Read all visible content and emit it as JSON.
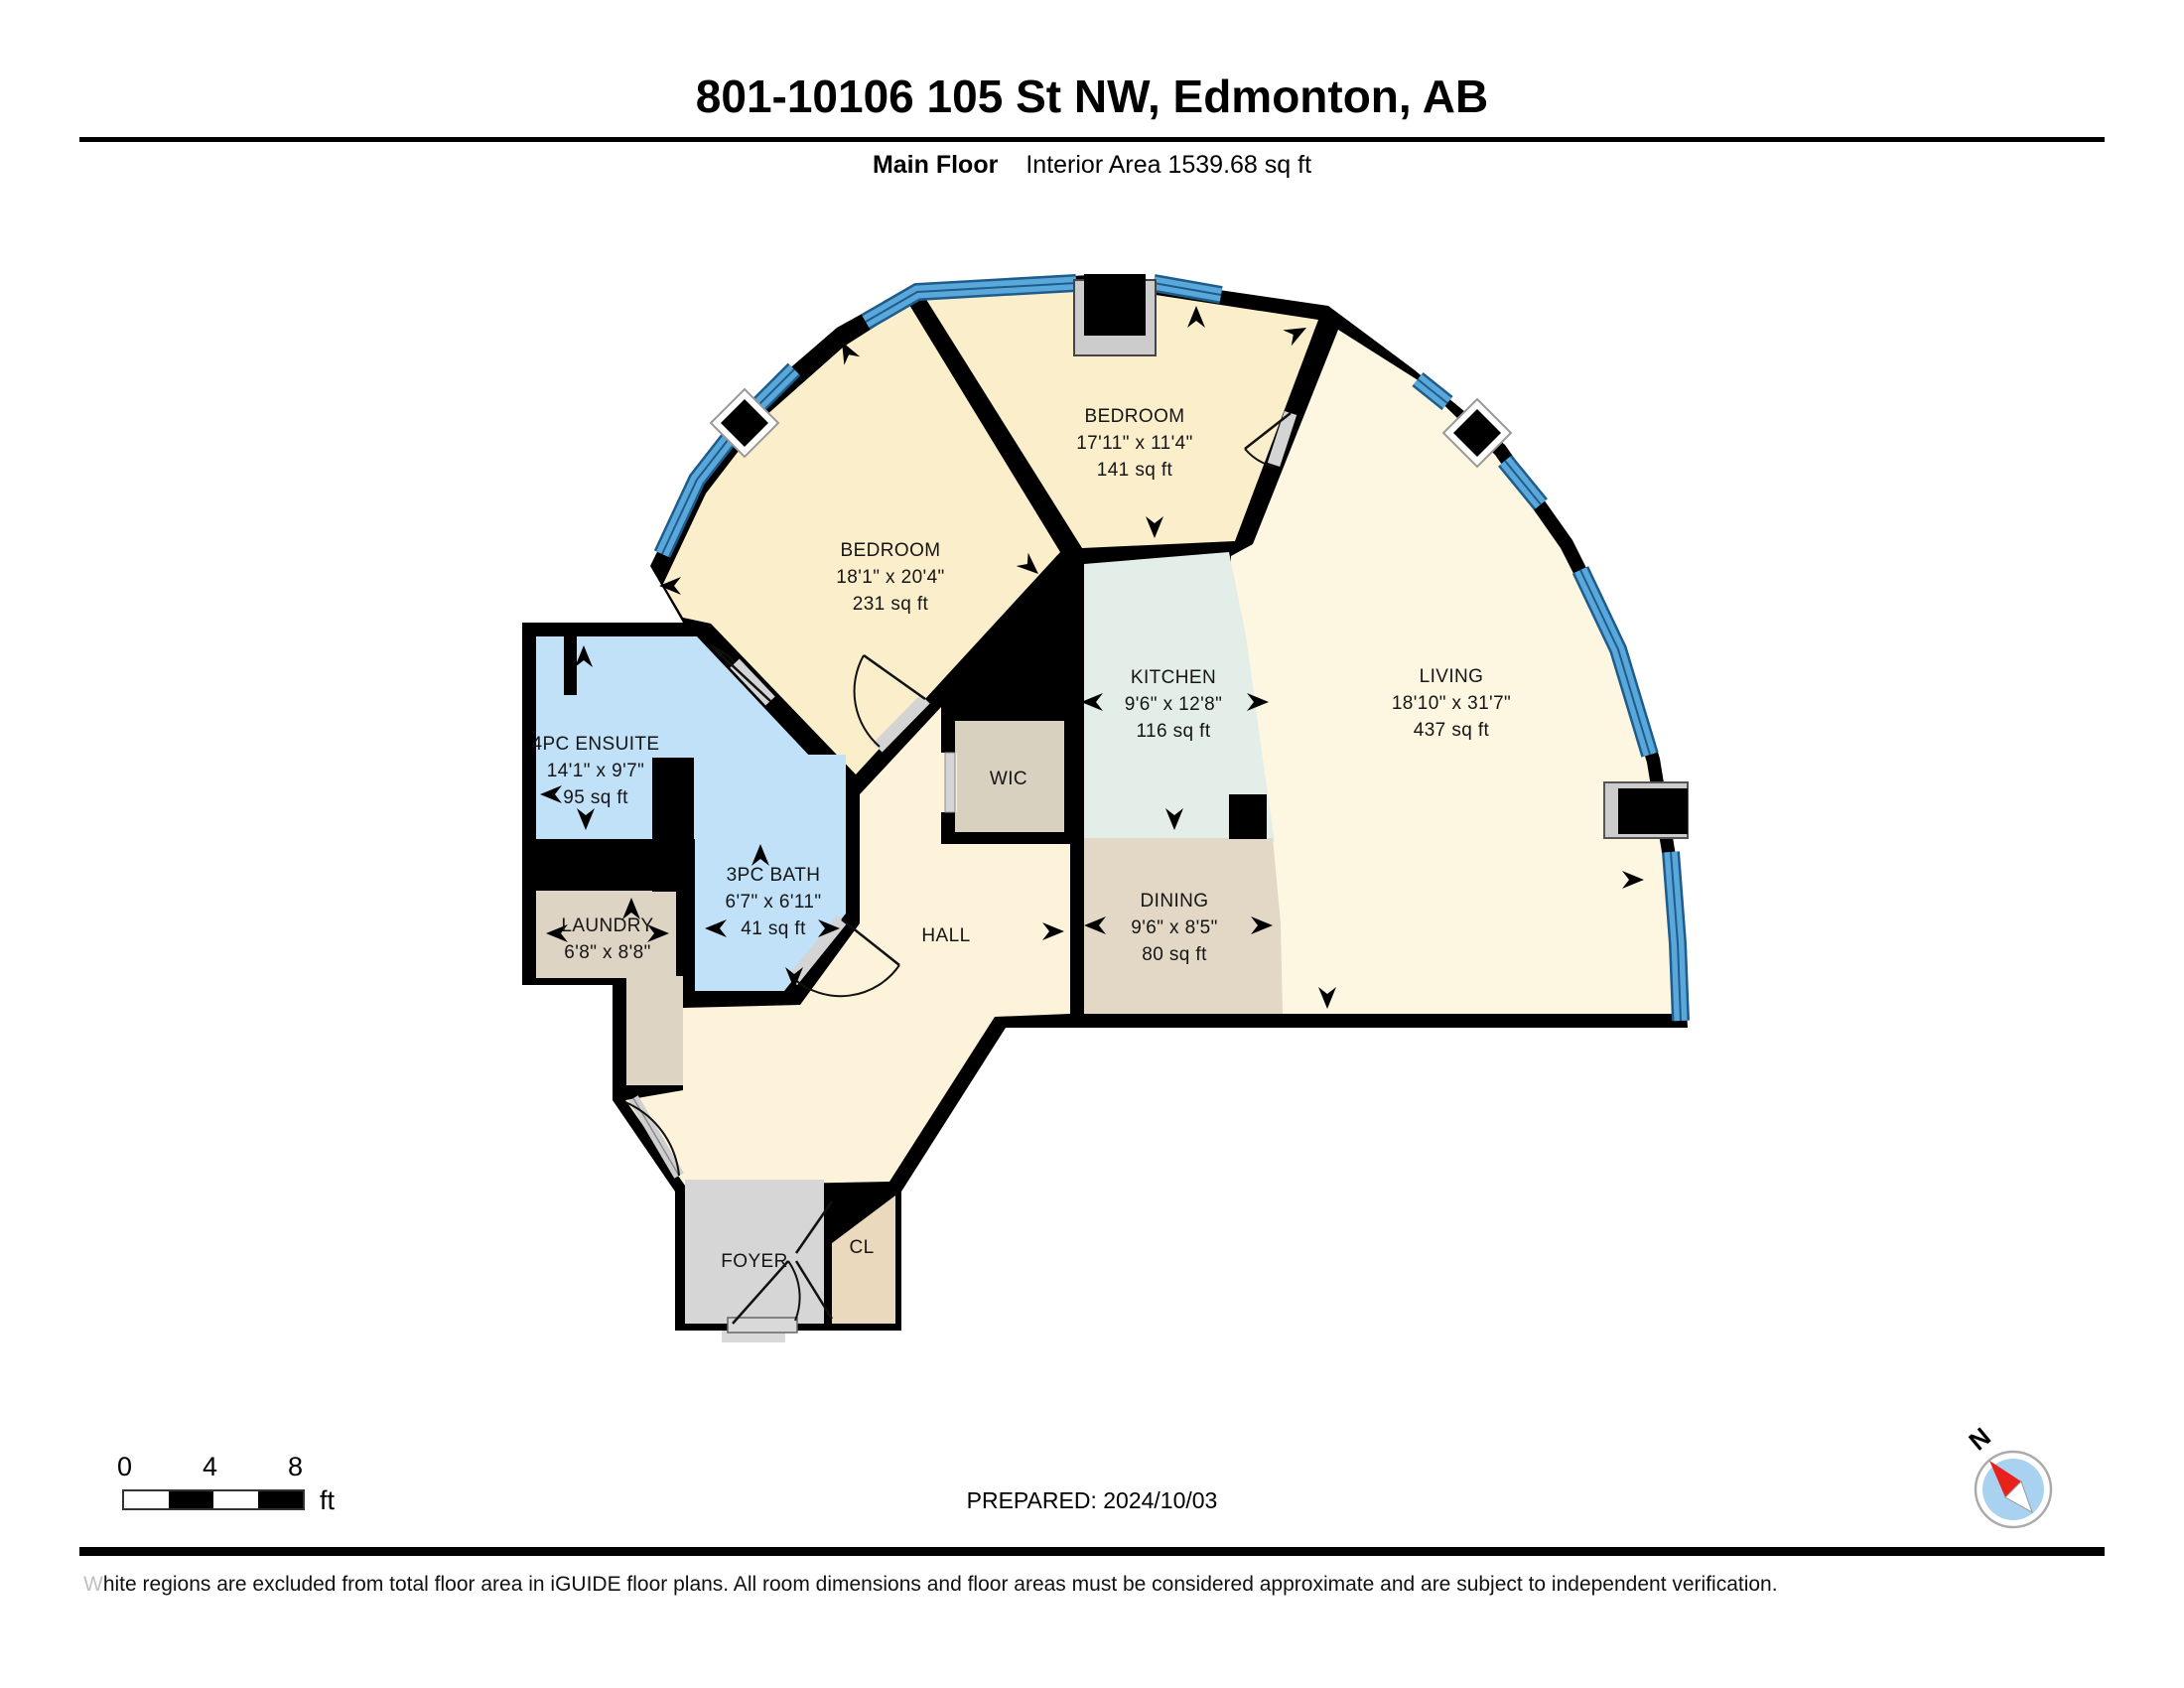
{
  "header": {
    "title": "801-10106 105 St NW, Edmonton, AB",
    "floor_label": "Main Floor",
    "area_label": "Interior Area 1539.68 sq ft"
  },
  "rooms": {
    "bedroom_left": {
      "name": "BEDROOM",
      "dims": "18'1\" x 20'4\"",
      "area": "231 sq ft"
    },
    "bedroom_top": {
      "name": "BEDROOM",
      "dims": "17'11\" x 11'4\"",
      "area": "141 sq ft"
    },
    "kitchen": {
      "name": "KITCHEN",
      "dims": "9'6\" x 12'8\"",
      "area": "116 sq ft"
    },
    "living": {
      "name": "LIVING",
      "dims": "18'10\" x 31'7\"",
      "area": "437 sq ft"
    },
    "dining": {
      "name": "DINING",
      "dims": "9'6\" x 8'5\"",
      "area": "80 sq ft"
    },
    "ensuite": {
      "name": "4PC ENSUITE",
      "dims": "14'1\" x 9'7\"",
      "area": "95 sq ft"
    },
    "bath": {
      "name": "3PC BATH",
      "dims": "6'7\" x 6'11\"",
      "area": "41 sq ft"
    },
    "laundry": {
      "name": "LAUNDRY",
      "dims": "6'8\" x 8'8\""
    },
    "wic": {
      "name": "WIC"
    },
    "hall": {
      "name": "HALL"
    },
    "foyer": {
      "name": "FOYER"
    },
    "closet": {
      "name": "CL"
    }
  },
  "scale_bar": {
    "ticks": [
      "0",
      "4",
      "8"
    ],
    "unit": "ft"
  },
  "compass": {
    "north_label": "N"
  },
  "footer": {
    "prepared": "PREPARED: 2024/10/03",
    "disclaimer": "White regions are excluded from total floor area in iGUIDE floor plans. All room dimensions and floor areas must be considered approximate and are subject to independent verification."
  },
  "colors": {
    "room_yellow": "#faeecb",
    "room_cream_living": "#fdf6e0",
    "room_cream_hall": "#fdf3da",
    "room_green": "#e3eee9",
    "room_tan": "#e2d8c5",
    "room_blue": "#c0e1f8",
    "room_gray": "#d6d6d6",
    "room_beige": "#ddd4c4",
    "closet_tan": "#ead9bd",
    "window_blue": "#5aa8da",
    "window_edge": "#1d5c8c",
    "wall": "#000000",
    "compass_red": "#e8211d",
    "compass_blue": "#a8d2ef"
  }
}
